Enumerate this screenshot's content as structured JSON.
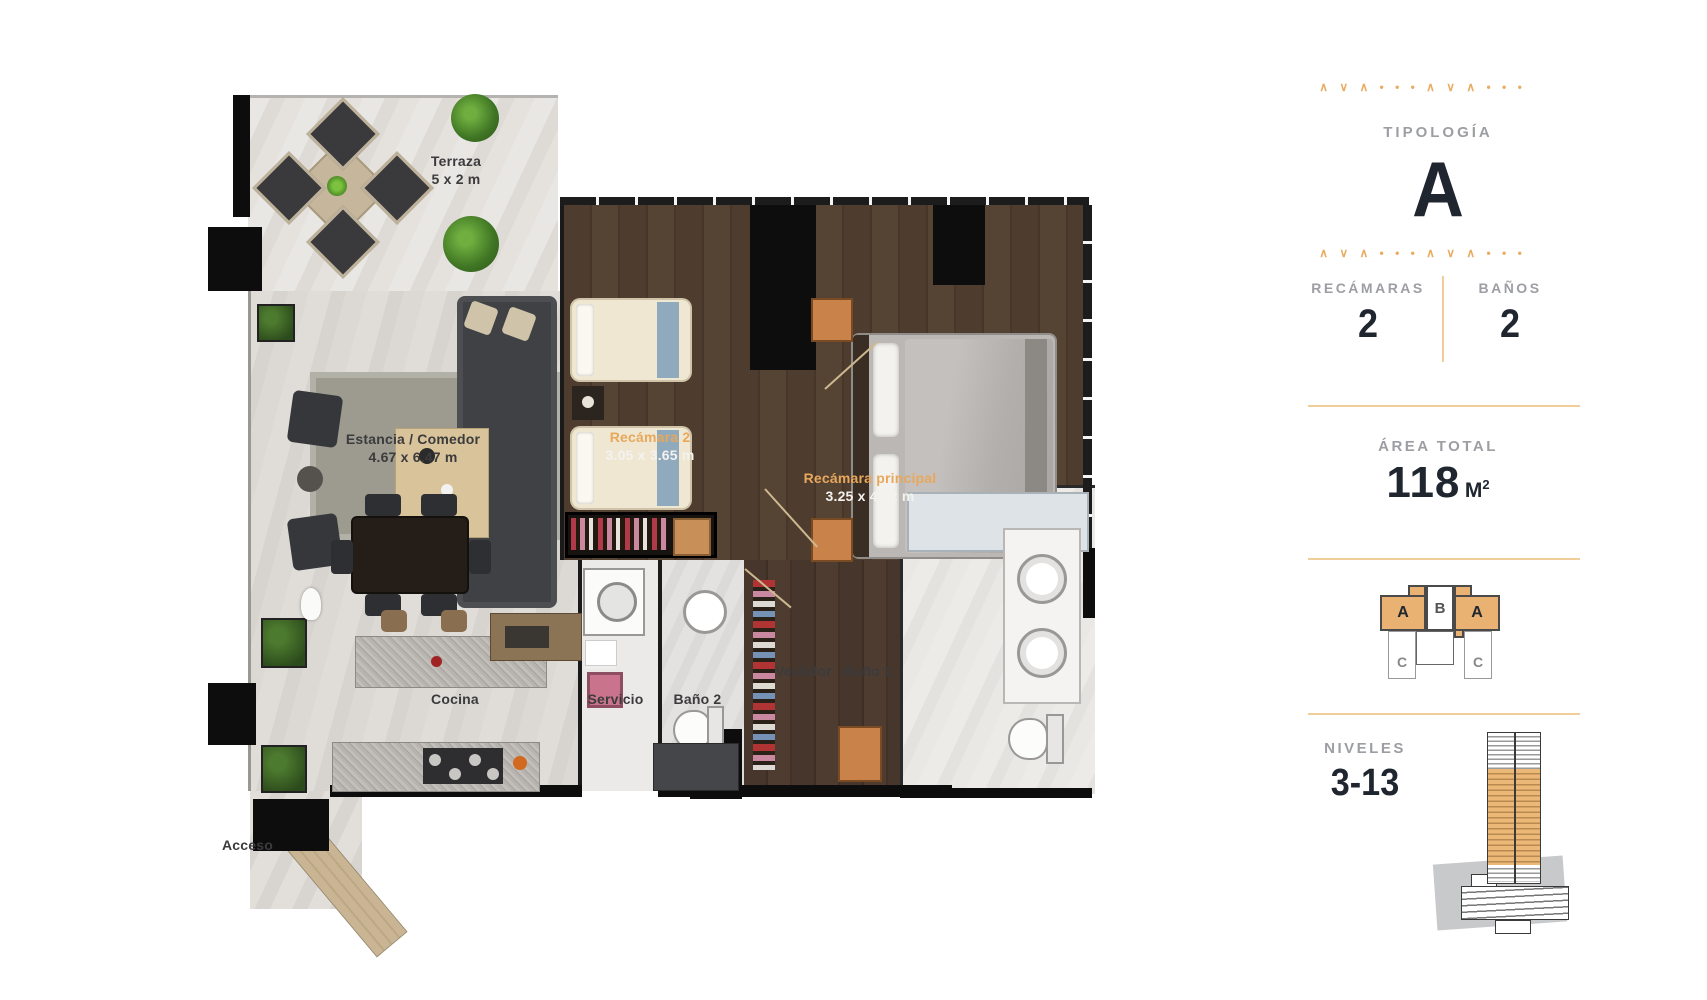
{
  "plan": {
    "rooms": {
      "terraza": {
        "name": "Terraza",
        "dims": "5 x 2 m"
      },
      "estancia": {
        "name": "Estancia / Comedor",
        "dims": "4.67 x 6.47 m"
      },
      "recamara2": {
        "name": "Recámara 2",
        "dims": "3.05 x 3.65 m"
      },
      "principal": {
        "name": "Recámara principal",
        "dims": "3.25 x 4.72 m"
      },
      "cocina": {
        "name": "Cocina"
      },
      "servicio": {
        "name": "Servicio"
      },
      "bano2": {
        "name": "Baño 2"
      },
      "vestidor": {
        "name": "Vestidor"
      },
      "bano1": {
        "name": "Baño 1"
      },
      "acceso": {
        "name": "Acceso"
      }
    }
  },
  "panel": {
    "decor_row": "∧ ∨ ∧ • • • ∧ ∨ ∧ • • •",
    "typology": {
      "label": "TIPOLOGÍA",
      "value": "A"
    },
    "bedrooms": {
      "label": "RECÁMARAS",
      "value": "2"
    },
    "bathrooms": {
      "label": "BAÑOS",
      "value": "2"
    },
    "area": {
      "label": "ÁREA TOTAL",
      "value": "118",
      "unit": "M",
      "unit_sup": "2"
    },
    "levels": {
      "label": "NIVELES",
      "value": "3-13"
    },
    "unit_map": {
      "units": [
        "A",
        "B",
        "A",
        "C",
        "C"
      ]
    }
  },
  "colors": {
    "accent": "#E9AC63",
    "divider": "#F0CD99",
    "dark_text": "#20262F",
    "gray_text": "#9C9EA3",
    "plan_orange": "#E8A85C"
  }
}
